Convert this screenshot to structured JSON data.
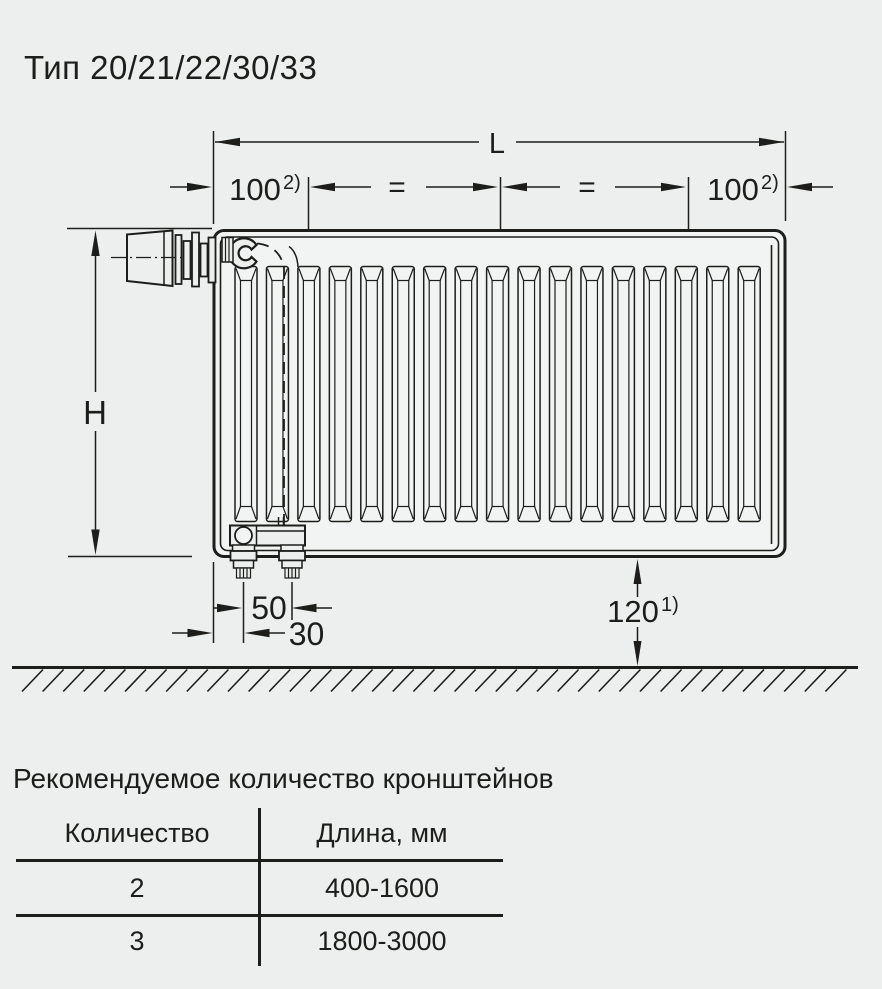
{
  "page": {
    "title": "Тип 20/21/22/30/33",
    "background_color": "#edefee",
    "line_color": "#1d1d1b"
  },
  "diagram": {
    "labels": {
      "length": "L",
      "height": "H",
      "equal_left": "=",
      "equal_right": "=",
      "offset_left_value": "100",
      "offset_left_note": "2)",
      "offset_right_value": "100",
      "offset_right_note": "2)",
      "pipe_spacing": "50",
      "edge_offset": "30",
      "floor_clearance_value": "120",
      "floor_clearance_note": "1)"
    },
    "radiator": {
      "channel_count": 17
    }
  },
  "brackets_table": {
    "caption": "Рекомендуемое количество кронштейнов",
    "columns": [
      "Количество",
      "Длина, мм"
    ],
    "rows": [
      {
        "quantity": "2",
        "length_mm": "400-1600"
      },
      {
        "quantity": "3",
        "length_mm": "1800-3000"
      }
    ]
  }
}
